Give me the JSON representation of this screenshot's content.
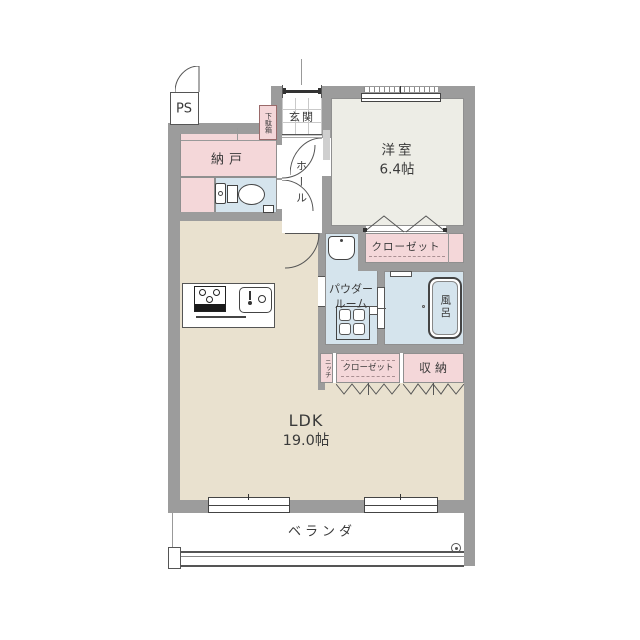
{
  "plan": {
    "type": "apartment-floor-plan",
    "rooms": {
      "ps": "PS",
      "shoe_cabinet": "下駄箱",
      "entrance": "玄関",
      "storage_room": "納戸",
      "hall": "ホール",
      "western_room": "洋室",
      "western_room_size": "6.4帖",
      "closet_upper": "クローゼット",
      "powder_room_line1": "パウダー",
      "powder_room_line2": "ルーム",
      "bath": "風呂",
      "niche": "ニッチ",
      "closet_lower": "クローゼット",
      "storage": "収納",
      "ldk": "LDK",
      "ldk_size": "19.0帖",
      "veranda": "ベランダ"
    },
    "colors": {
      "wall": "#9c9c9c",
      "room_pink": "#f4d7d9",
      "room_blue": "#d5e4ed",
      "room_beige": "#e9e1cf",
      "room_light_gray": "#edede6",
      "line": "#555555",
      "text": "#333333"
    }
  }
}
